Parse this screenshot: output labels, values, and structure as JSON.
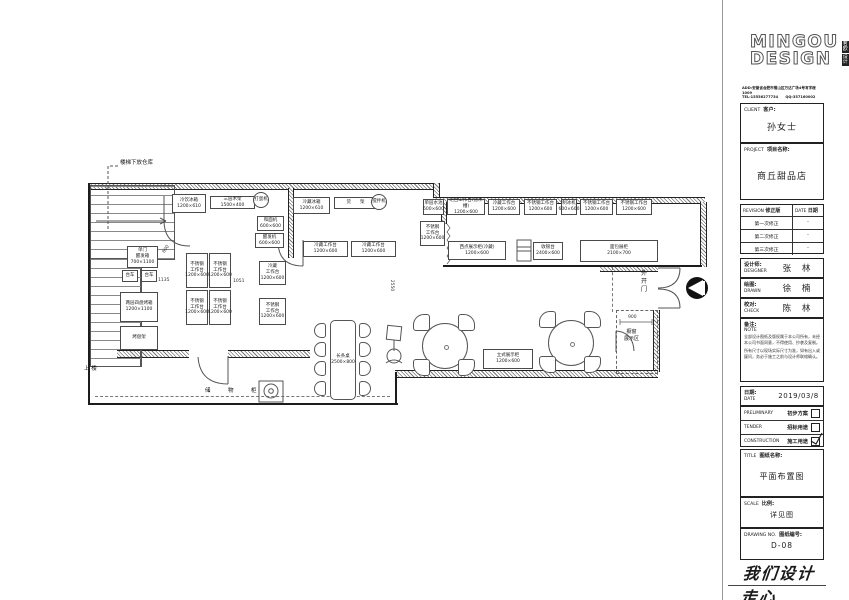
{
  "logo": {
    "line1": "MINGOU",
    "line2": "DESIGN",
    "cn_top": "茗欧",
    "cn_bottom": "设计",
    "address1": "ADD:安徽省合肥市蜀山区万达广场4号写字楼1009",
    "address2": "TEL:15556277734　　QQ:357160002"
  },
  "titleblock": {
    "client": {
      "en": "CLIENT",
      "cn": "客户:",
      "value": "孙女士"
    },
    "project": {
      "en": "PROJECT",
      "cn": "项目名称:",
      "value": "商丘甜品店"
    },
    "revision": {
      "en": "REVISION",
      "cn": "修正版",
      "date_en": "DATE",
      "date_cn": "日期",
      "rows": [
        {
          "name": "第一次修正",
          "date": "-"
        },
        {
          "name": "第二次修正",
          "date": "-"
        },
        {
          "name": "第三次修正",
          "date": "-"
        }
      ]
    },
    "designer": {
      "cn": "设计师:",
      "en": "DESIGNER",
      "value": "张 林"
    },
    "drawn": {
      "cn": "绘图:",
      "en": "DRAWN",
      "value": "徐 楠"
    },
    "check": {
      "cn": "校对:",
      "en": "CHECK",
      "value": "陈 林"
    },
    "note": {
      "cn": "备注:",
      "en": "NOTE",
      "para1": "全部设计图纸及版权属于本公司所有，未经本公司书面同意，不得使用、抄袭及复制。",
      "para2": "所有尺寸以现场实际尺寸为准，如有出入或疑问，务必于施工之前与设计师联络确认。"
    },
    "date": {
      "cn": "日期:",
      "en": "DATE",
      "value": "2019/03/8"
    },
    "phases": [
      {
        "en": "PRELIMINARY",
        "cn": "初步方案",
        "checked": false
      },
      {
        "en": "TENDER",
        "cn": "招标用途",
        "checked": false
      },
      {
        "en": "CONSTRUCTION",
        "cn": "施工用途",
        "checked": true
      }
    ],
    "title": {
      "en": "TITLE",
      "cn": "图纸名称:",
      "value": "平面布置图"
    },
    "scale": {
      "en": "SCALE",
      "cn": "比例:",
      "value": "详见图"
    },
    "drawing": {
      "en": "DRAWING NO.",
      "cn": "图纸编号:",
      "value": "D-08"
    },
    "slogan": "我们设计走心"
  },
  "plan": {
    "annotations": {
      "under_stairs": "楼梯下放仓库",
      "up_stairs": "上 楼",
      "storage_cabinet": "储　物　柜",
      "outward_door": "外\n开\n门",
      "window_display": "橱窗\n展示区",
      "long_table": "长条桌\n2500×800"
    },
    "dims": {
      "d1135": "1135",
      "d1051": "1051",
      "d2550": "2550",
      "d900": "900",
      "d600": "600"
    },
    "equipment": [
      {
        "x": 172,
        "y": 194,
        "w": 34,
        "h": 19,
        "text": "冷饮冰箱\n1200×610"
      },
      {
        "x": 210,
        "y": 196,
        "w": 45,
        "h": 13,
        "text": "三层木架\n1500×400"
      },
      {
        "x": 253,
        "y": 192,
        "w": 16,
        "h": 16,
        "shape": "circle",
        "text": "打蛋机"
      },
      {
        "x": 257,
        "y": 216,
        "w": 27,
        "h": 15,
        "text": "和面机\n600×600"
      },
      {
        "x": 255,
        "y": 233,
        "w": 29,
        "h": 15,
        "text": "醒发机\n600×600"
      },
      {
        "x": 127,
        "y": 246,
        "w": 31,
        "h": 22,
        "text": "单门\n醒发箱\n700×1100"
      },
      {
        "x": 122,
        "y": 270,
        "w": 16,
        "h": 12,
        "text": "台车"
      },
      {
        "x": 141,
        "y": 270,
        "w": 16,
        "h": 12,
        "text": "台车"
      },
      {
        "x": 120,
        "y": 292,
        "w": 38,
        "h": 30,
        "text": "两层四盘烤箱\n1200×1100"
      },
      {
        "x": 120,
        "y": 326,
        "w": 38,
        "h": 24,
        "text": "烤盘架"
      },
      {
        "x": 186,
        "y": 253,
        "w": 22,
        "h": 35,
        "text": "不锈钢\n工作台\n1200×600"
      },
      {
        "x": 209,
        "y": 253,
        "w": 22,
        "h": 35,
        "text": "不锈钢\n工作台\n1200×600"
      },
      {
        "x": 186,
        "y": 290,
        "w": 22,
        "h": 35,
        "text": "不锈钢\n工作台\n1200×600"
      },
      {
        "x": 209,
        "y": 290,
        "w": 22,
        "h": 35,
        "text": "不锈钢\n工作台\n1200×600"
      },
      {
        "x": 259,
        "y": 261,
        "w": 27,
        "h": 24,
        "text": "冷藏\n工作台\n1200×600"
      },
      {
        "x": 259,
        "y": 298,
        "w": 27,
        "h": 27,
        "text": "不锈钢\n工作台\n1200×600"
      },
      {
        "x": 293,
        "y": 197,
        "w": 37,
        "h": 17,
        "text": "冷藏冰箱\n1200×610"
      },
      {
        "x": 334,
        "y": 197,
        "w": 43,
        "h": 12,
        "text": "货　　架"
      },
      {
        "x": 371,
        "y": 194,
        "w": 16,
        "h": 16,
        "shape": "circle",
        "text": "搅拌机"
      },
      {
        "x": 303,
        "y": 241,
        "w": 45,
        "h": 16,
        "text": "冷藏工作台\n1200×600"
      },
      {
        "x": 351,
        "y": 241,
        "w": 45,
        "h": 16,
        "text": "冷藏工作台\n1200×600"
      },
      {
        "x": 423,
        "y": 199,
        "w": 21,
        "h": 16,
        "text": "单层水池\n600×600"
      },
      {
        "x": 447,
        "y": 199,
        "w": 38,
        "h": 16,
        "text": "吧台工作台(含水槽)\n1200×600"
      },
      {
        "x": 488,
        "y": 199,
        "w": 32,
        "h": 16,
        "text": "冷藏工作台\n1200×600"
      },
      {
        "x": 524,
        "y": 199,
        "w": 33,
        "h": 16,
        "text": "不锈钢工作台\n1200×600"
      },
      {
        "x": 561,
        "y": 199,
        "w": 16,
        "h": 16,
        "text": "制冰机\n600×600"
      },
      {
        "x": 580,
        "y": 199,
        "w": 33,
        "h": 16,
        "text": "不锈钢工作台\n1200×600"
      },
      {
        "x": 616,
        "y": 199,
        "w": 36,
        "h": 16,
        "text": "不锈钢工作台\n1200×600"
      },
      {
        "x": 420,
        "y": 221,
        "w": 25,
        "h": 25,
        "text": "不锈钢\n工作台\n1200×600"
      },
      {
        "x": 448,
        "y": 241,
        "w": 58,
        "h": 19,
        "text": "西点展示柜(冷藏)\n1200×600"
      },
      {
        "x": 533,
        "y": 242,
        "w": 30,
        "h": 18,
        "text": "收银台\n2400×600"
      },
      {
        "x": 580,
        "y": 240,
        "w": 78,
        "h": 22,
        "text": "面包展柜\n2100×700"
      },
      {
        "x": 483,
        "y": 349,
        "w": 50,
        "h": 20,
        "text": "立式展示柜\n1200×600"
      }
    ]
  }
}
